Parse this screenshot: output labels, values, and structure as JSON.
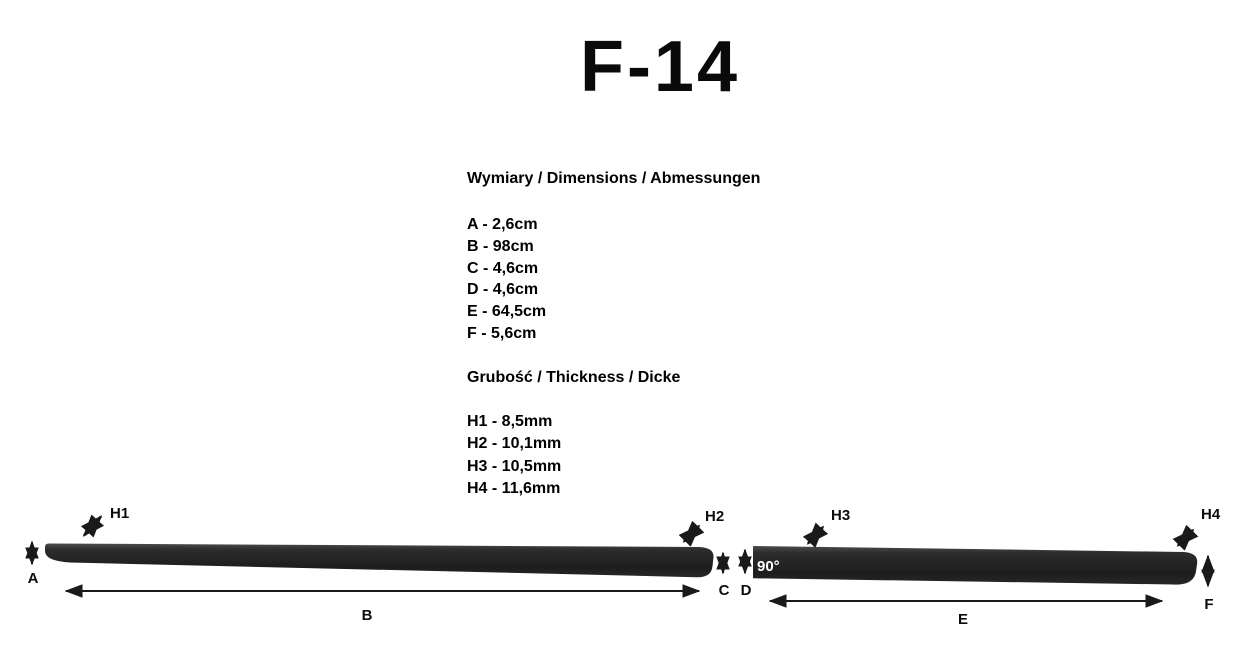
{
  "title": "F-14",
  "dimensions": {
    "heading": "Wymiary / Dimensions / Abmessungen",
    "items": [
      {
        "key": "A",
        "value": "2,6cm",
        "text": "A - 2,6cm"
      },
      {
        "key": "B",
        "value": "98cm",
        "text": "B - 98cm"
      },
      {
        "key": "C",
        "value": "4,6cm",
        "text": "C - 4,6cm"
      },
      {
        "key": "D",
        "value": "4,6cm",
        "text": "D - 4,6cm"
      },
      {
        "key": "E",
        "value": "64,5cm",
        "text": "E - 64,5cm"
      },
      {
        "key": "F",
        "value": "5,6cm",
        "text": "F - 5,6cm"
      }
    ]
  },
  "thickness": {
    "heading": "Grubość / Thickness / Dicke",
    "items": [
      {
        "key": "H1",
        "value": "8,5mm",
        "text": "H1 - 8,5mm"
      },
      {
        "key": "H2",
        "value": "10,1mm",
        "text": "H2 - 10,1mm"
      },
      {
        "key": "H3",
        "value": "10,5mm",
        "text": "H3 - 10,5mm"
      },
      {
        "key": "H4",
        "value": "11,6mm",
        "text": "H4 - 11,6mm"
      }
    ]
  },
  "diagram": {
    "labels": {
      "a": "A",
      "b": "B",
      "c": "C",
      "d": "D",
      "e": "E",
      "f": "F",
      "h1": "H1",
      "h2": "H2",
      "h3": "H3",
      "h4": "H4",
      "angle": "90°"
    },
    "colors": {
      "strip": "#262626",
      "strip_highlight": "#4c4c4c",
      "line": "#1a1a1a",
      "angle_text": "#ffffff",
      "background": "#ffffff"
    }
  }
}
